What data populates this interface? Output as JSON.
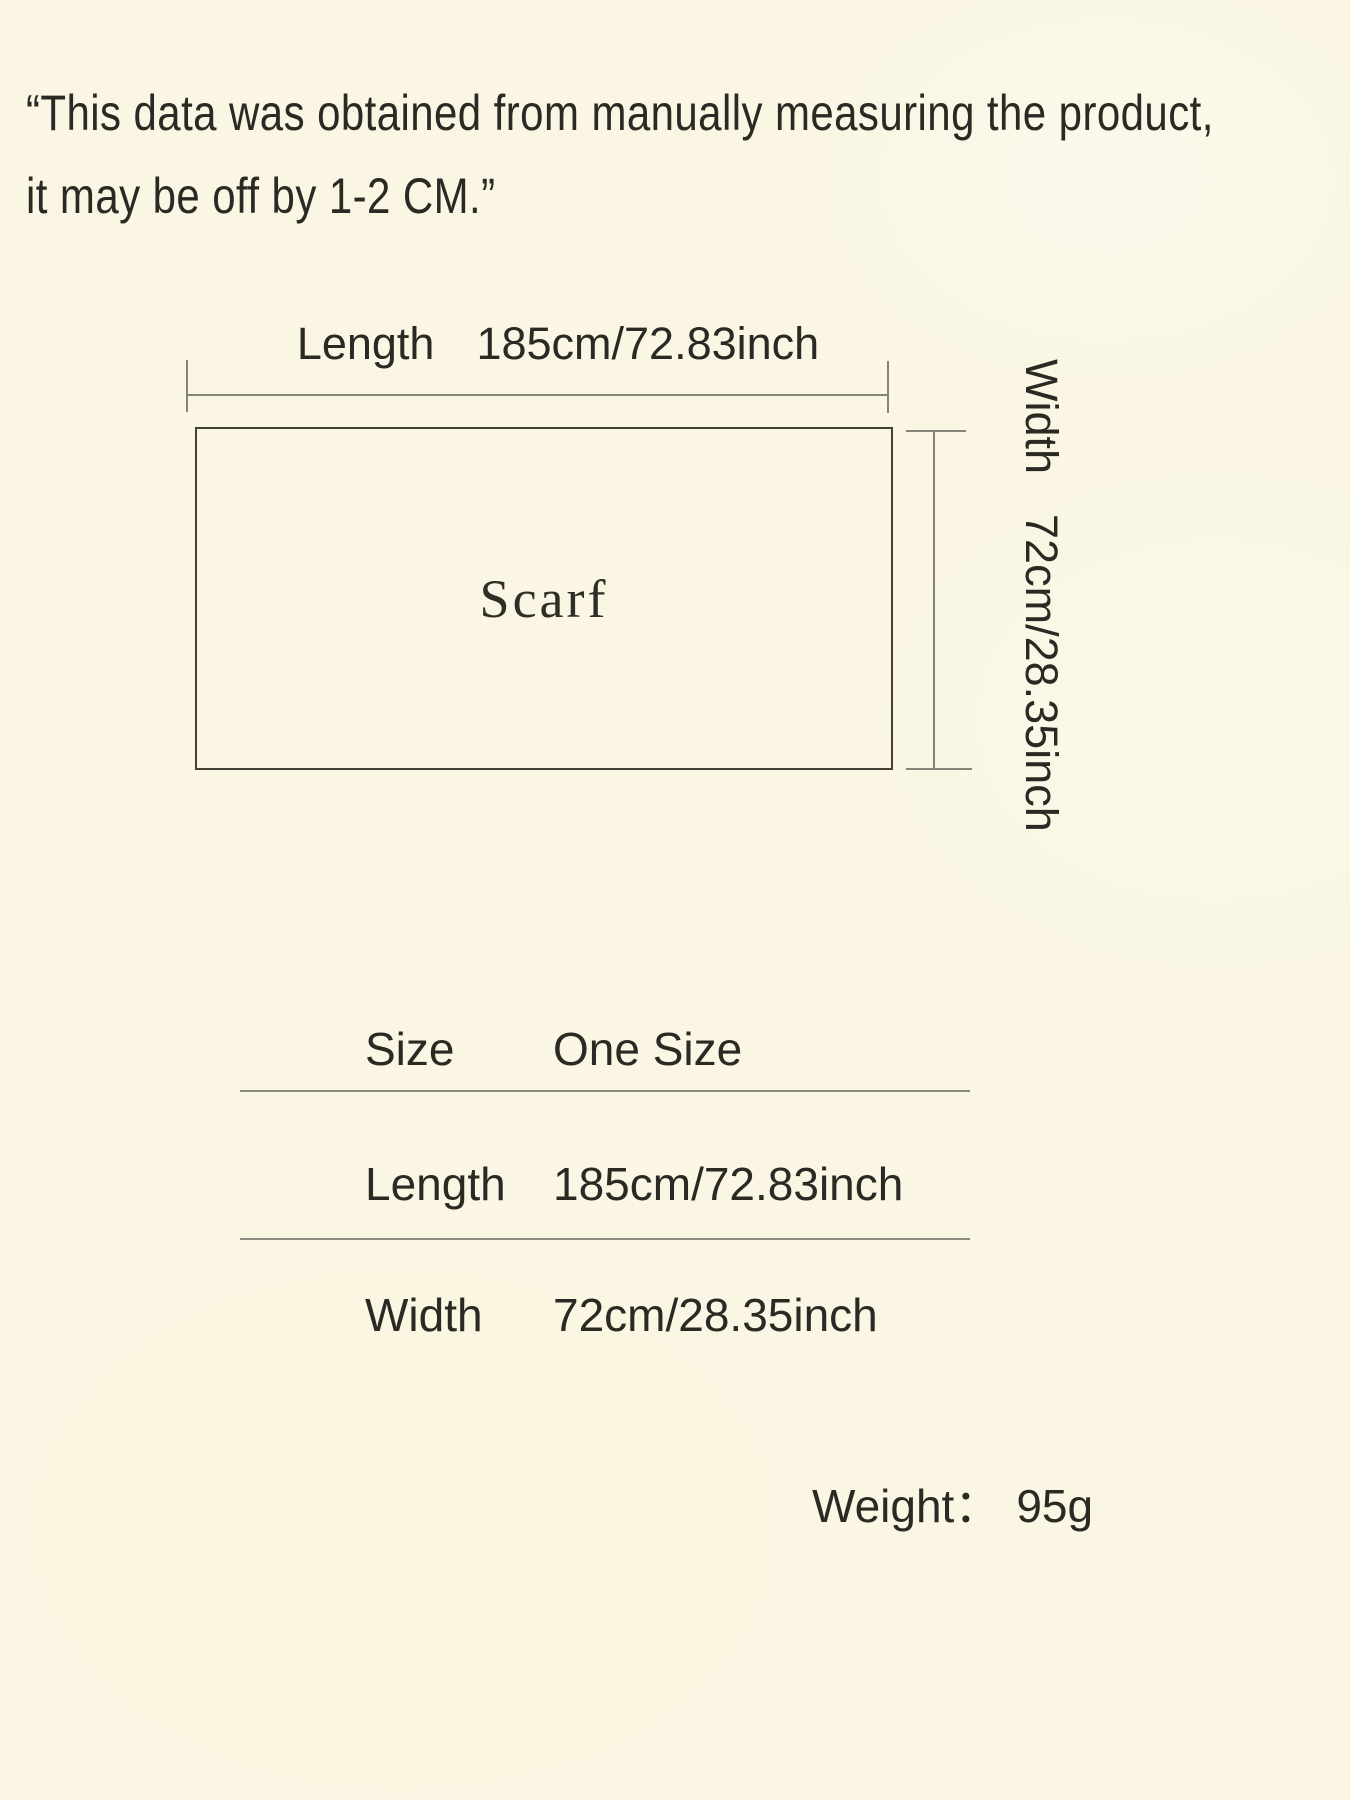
{
  "page": {
    "background_color": "#faf6e3",
    "ink_color": "#2a2923",
    "outline_color": "#434136",
    "dimension_line_color": "#85847b",
    "divider_color": "#8b8a80"
  },
  "disclaimer": {
    "line1": "“This data was obtained from manually measuring the product,",
    "line2": "it may be off by 1-2 CM.”"
  },
  "diagram": {
    "product_label": "Scarf",
    "length": {
      "label": "Length",
      "value": "185cm/72.83inch"
    },
    "width": {
      "label": "Width",
      "value": "72cm/28.35inch"
    }
  },
  "size_table": {
    "rows": [
      {
        "label": "Size",
        "value": "One Size"
      },
      {
        "label": "Length",
        "value": "185cm/72.83inch"
      },
      {
        "label": "Width",
        "value": "72cm/28.35inch"
      }
    ]
  },
  "weight": {
    "label": "Weight：",
    "value": "95g"
  }
}
